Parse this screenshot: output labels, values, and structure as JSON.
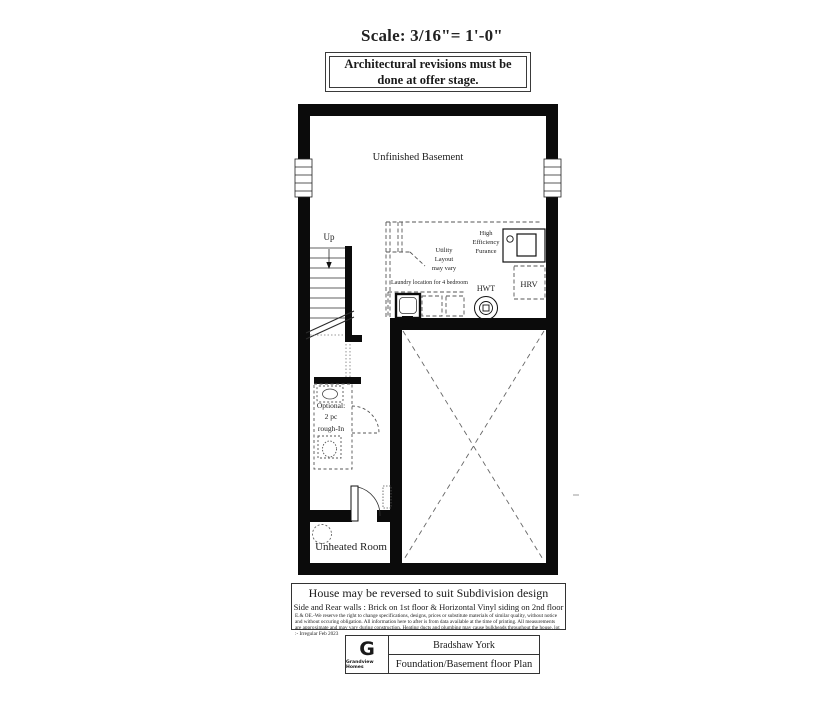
{
  "header": {
    "scale": "Scale: 3/16\"= 1'-0\"",
    "revisions": "Architectural revisions must be\ndone at offer stage."
  },
  "plan": {
    "basement_label": "Unfinished Basement",
    "up_label": "Up",
    "utility_note": "Utility\nLayout\nmay vary",
    "furnace_label": "High\nEfficiency\nFurance",
    "laundry_note": "Laundry location for 4 bedroom",
    "hwt_label": "HWT",
    "hrv_label": "HRV",
    "bath_label": "Optional:\n2 pc\nrough-In",
    "unheated_label": "Unheated Room"
  },
  "notes": {
    "reversal": "House may be reversed to suit Subdivision design",
    "walls": "Side and Rear walls : Brick on 1st floor & Horizontal Vinyl siding on 2nd floor",
    "disclaimer": "E.& OE.-We reserve the right to change specifications, designs, prices or substitute materials of similar quality, without notice and without occuring obligation. All information here to after is from data available at the time of printing. All measurements are approximate and may vary during construction. Heating ducts and plumbing may cause bulkheads throughout the house. lot :- Irregular Feb 2023"
  },
  "title_block": {
    "logo_letter": "G",
    "company": "Grandview Homes",
    "model": "Bradshaw York",
    "sheet": "Foundation/Basement floor Plan"
  },
  "colors": {
    "wall": "#0b0b0b",
    "line": "#333333",
    "dashed": "#555555"
  }
}
